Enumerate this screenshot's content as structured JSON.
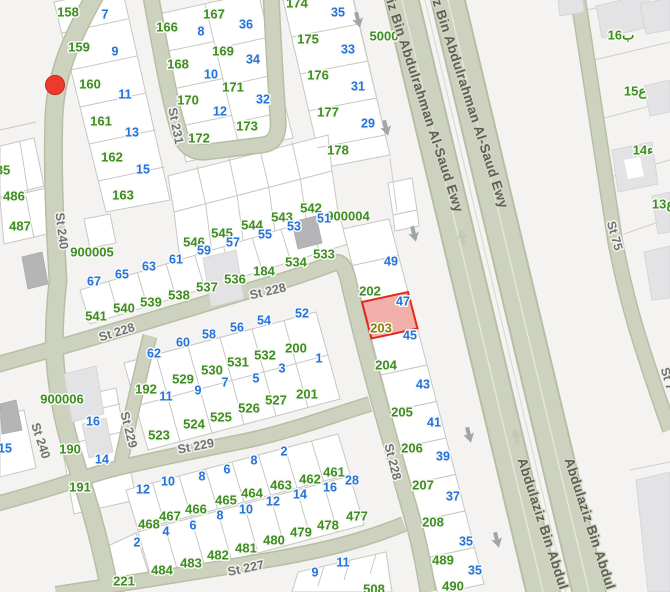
{
  "map": {
    "canvas": {
      "width": 670,
      "height": 592
    },
    "colors": {
      "parcel_number_green": "#3d8e20",
      "house_number_blue": "#2273dd",
      "selected_number_olive": "#8d7c0a",
      "street_label_gray": "#6f7273",
      "highway_label": "#5d6155",
      "road_fill": "#cdd2be",
      "selected_parcel_fill": "#f2a29c",
      "selected_parcel_stroke": "#e02a1e",
      "marker_red": "#ee3a2e"
    },
    "marker": {
      "x": 55,
      "y": 85,
      "r": 9.5
    },
    "selected_parcel": {
      "label": "203",
      "points": "362,302 408,292 417.5,328.5 371.5,338.5"
    },
    "labels": [
      {
        "t": "158",
        "x": 68,
        "y": 13,
        "c": "g"
      },
      {
        "t": "7",
        "x": 105,
        "y": 15,
        "c": "b"
      },
      {
        "t": "159",
        "x": 79,
        "y": 48,
        "c": "g"
      },
      {
        "t": "9",
        "x": 115,
        "y": 52,
        "c": "b"
      },
      {
        "t": "160",
        "x": 90,
        "y": 85,
        "c": "g"
      },
      {
        "t": "11",
        "x": 125,
        "y": 95,
        "c": "b"
      },
      {
        "t": "161",
        "x": 101,
        "y": 122,
        "c": "g"
      },
      {
        "t": "13",
        "x": 132,
        "y": 133,
        "c": "b"
      },
      {
        "t": "162",
        "x": 112,
        "y": 158,
        "c": "g"
      },
      {
        "t": "15",
        "x": 143,
        "y": 170,
        "c": "b"
      },
      {
        "t": "163",
        "x": 123,
        "y": 196,
        "c": "g"
      },
      {
        "t": "166",
        "x": 167,
        "y": 28,
        "c": "g"
      },
      {
        "t": "8",
        "x": 201,
        "y": 32,
        "c": "b"
      },
      {
        "t": "167",
        "x": 214,
        "y": 15,
        "c": "g"
      },
      {
        "t": "36",
        "x": 246,
        "y": 25,
        "c": "b"
      },
      {
        "t": "168",
        "x": 178,
        "y": 65,
        "c": "g"
      },
      {
        "t": "10",
        "x": 211,
        "y": 75,
        "c": "b"
      },
      {
        "t": "169",
        "x": 223,
        "y": 52,
        "c": "g"
      },
      {
        "t": "34",
        "x": 253,
        "y": 60,
        "c": "b"
      },
      {
        "t": "170",
        "x": 188,
        "y": 101,
        "c": "g"
      },
      {
        "t": "12",
        "x": 220,
        "y": 112,
        "c": "b"
      },
      {
        "t": "171",
        "x": 233,
        "y": 88,
        "c": "g"
      },
      {
        "t": "32",
        "x": 263,
        "y": 100,
        "c": "b"
      },
      {
        "t": "172",
        "x": 199,
        "y": 139,
        "c": "g"
      },
      {
        "t": "173",
        "x": 247,
        "y": 127,
        "c": "g"
      },
      {
        "t": "174",
        "x": 297,
        "y": 4,
        "c": "g"
      },
      {
        "t": "35",
        "x": 338,
        "y": 13,
        "c": "b"
      },
      {
        "t": "175",
        "x": 308,
        "y": 40,
        "c": "g"
      },
      {
        "t": "33",
        "x": 348,
        "y": 50,
        "c": "b"
      },
      {
        "t": "176",
        "x": 318,
        "y": 76,
        "c": "g"
      },
      {
        "t": "31",
        "x": 358,
        "y": 87,
        "c": "b"
      },
      {
        "t": "177",
        "x": 328,
        "y": 113,
        "c": "g"
      },
      {
        "t": "29",
        "x": 368,
        "y": 124,
        "c": "b"
      },
      {
        "t": "178",
        "x": 338,
        "y": 151,
        "c": "g"
      },
      {
        "t": "35",
        "x": 3,
        "y": 171,
        "c": "g"
      },
      {
        "t": "486",
        "x": 14,
        "y": 197,
        "c": "g"
      },
      {
        "t": "487",
        "x": 20,
        "y": 227,
        "c": "g"
      },
      {
        "t": "15",
        "x": 5,
        "y": 449,
        "c": "b"
      },
      {
        "t": "5000",
        "x": 384,
        "y": 37,
        "c": "g"
      },
      {
        "t": "900004",
        "x": 348,
        "y": 217,
        "c": "g"
      },
      {
        "t": "900005",
        "x": 92,
        "y": 253,
        "c": "g"
      },
      {
        "t": "900006",
        "x": 62,
        "y": 400,
        "c": "g"
      },
      {
        "t": "546",
        "x": 194,
        "y": 243,
        "c": "g"
      },
      {
        "t": "545",
        "x": 222,
        "y": 234,
        "c": "g"
      },
      {
        "t": "544",
        "x": 252,
        "y": 226,
        "c": "g"
      },
      {
        "t": "543",
        "x": 282,
        "y": 218,
        "c": "g"
      },
      {
        "t": "542",
        "x": 311,
        "y": 209,
        "c": "g"
      },
      {
        "t": "59",
        "x": 204,
        "y": 251,
        "c": "b"
      },
      {
        "t": "57",
        "x": 233,
        "y": 243,
        "c": "b"
      },
      {
        "t": "55",
        "x": 265,
        "y": 235,
        "c": "b"
      },
      {
        "t": "53",
        "x": 294,
        "y": 227,
        "c": "b"
      },
      {
        "t": "51",
        "x": 324,
        "y": 219,
        "c": "b"
      },
      {
        "t": "67",
        "x": 94,
        "y": 282,
        "c": "b"
      },
      {
        "t": "65",
        "x": 122,
        "y": 275,
        "c": "b"
      },
      {
        "t": "63",
        "x": 149,
        "y": 267,
        "c": "b"
      },
      {
        "t": "61",
        "x": 176,
        "y": 260,
        "c": "b"
      },
      {
        "t": "541",
        "x": 96,
        "y": 317,
        "c": "g"
      },
      {
        "t": "540",
        "x": 124,
        "y": 309,
        "c": "g"
      },
      {
        "t": "539",
        "x": 151,
        "y": 303,
        "c": "g"
      },
      {
        "t": "538",
        "x": 179,
        "y": 296,
        "c": "g"
      },
      {
        "t": "537",
        "x": 207,
        "y": 288,
        "c": "g"
      },
      {
        "t": "536",
        "x": 235,
        "y": 280,
        "c": "g"
      },
      {
        "t": "184",
        "x": 264,
        "y": 272,
        "c": "g"
      },
      {
        "t": "534",
        "x": 296,
        "y": 263,
        "c": "g"
      },
      {
        "t": "533",
        "x": 324,
        "y": 255,
        "c": "g"
      },
      {
        "t": "192",
        "x": 146,
        "y": 390,
        "c": "g"
      },
      {
        "t": "62",
        "x": 154,
        "y": 354,
        "c": "b"
      },
      {
        "t": "529",
        "x": 183,
        "y": 380,
        "c": "g"
      },
      {
        "t": "60",
        "x": 183,
        "y": 343,
        "c": "b"
      },
      {
        "t": "530",
        "x": 212,
        "y": 371,
        "c": "g"
      },
      {
        "t": "58",
        "x": 209,
        "y": 335,
        "c": "b"
      },
      {
        "t": "531",
        "x": 238,
        "y": 363,
        "c": "g"
      },
      {
        "t": "56",
        "x": 237,
        "y": 328,
        "c": "b"
      },
      {
        "t": "532",
        "x": 265,
        "y": 356,
        "c": "g"
      },
      {
        "t": "54",
        "x": 264,
        "y": 321,
        "c": "b"
      },
      {
        "t": "200",
        "x": 296,
        "y": 349,
        "c": "g"
      },
      {
        "t": "52",
        "x": 302,
        "y": 314,
        "c": "b"
      },
      {
        "t": "523",
        "x": 159,
        "y": 436,
        "c": "g"
      },
      {
        "t": "11",
        "x": 166,
        "y": 397,
        "c": "b"
      },
      {
        "t": "524",
        "x": 194,
        "y": 425,
        "c": "g"
      },
      {
        "t": "9",
        "x": 198,
        "y": 391,
        "c": "b"
      },
      {
        "t": "525",
        "x": 221,
        "y": 418,
        "c": "g"
      },
      {
        "t": "7",
        "x": 225,
        "y": 383,
        "c": "b"
      },
      {
        "t": "526",
        "x": 249,
        "y": 409,
        "c": "g"
      },
      {
        "t": "5",
        "x": 256,
        "y": 379,
        "c": "b"
      },
      {
        "t": "527",
        "x": 276,
        "y": 401,
        "c": "g"
      },
      {
        "t": "3",
        "x": 282,
        "y": 369,
        "c": "b"
      },
      {
        "t": "201",
        "x": 307,
        "y": 395,
        "c": "g"
      },
      {
        "t": "1",
        "x": 319,
        "y": 359,
        "c": "b"
      },
      {
        "t": "16",
        "x": 93,
        "y": 422,
        "c": "b"
      },
      {
        "t": "190",
        "x": 70,
        "y": 450,
        "c": "g"
      },
      {
        "t": "14",
        "x": 102,
        "y": 460,
        "c": "b"
      },
      {
        "t": "191",
        "x": 80,
        "y": 488,
        "c": "g"
      },
      {
        "t": "49",
        "x": 391,
        "y": 262,
        "c": "b"
      },
      {
        "t": "202",
        "x": 370,
        "y": 292,
        "c": "g"
      },
      {
        "t": "203",
        "x": 381,
        "y": 329,
        "c": "o",
        "n": "selected-parcel-label"
      },
      {
        "t": "47",
        "x": 403,
        "y": 302,
        "c": "b"
      },
      {
        "t": "45",
        "x": 410,
        "y": 336,
        "c": "b"
      },
      {
        "t": "204",
        "x": 386,
        "y": 366,
        "c": "g"
      },
      {
        "t": "43",
        "x": 423,
        "y": 385,
        "c": "b"
      },
      {
        "t": "205",
        "x": 402,
        "y": 413,
        "c": "g"
      },
      {
        "t": "41",
        "x": 434,
        "y": 423,
        "c": "b"
      },
      {
        "t": "206",
        "x": 412,
        "y": 449,
        "c": "g"
      },
      {
        "t": "39",
        "x": 443,
        "y": 457,
        "c": "b"
      },
      {
        "t": "207",
        "x": 423,
        "y": 486,
        "c": "g"
      },
      {
        "t": "37",
        "x": 453,
        "y": 497,
        "c": "b"
      },
      {
        "t": "208",
        "x": 433,
        "y": 523,
        "c": "g"
      },
      {
        "t": "35",
        "x": 466,
        "y": 542,
        "c": "b"
      },
      {
        "t": "489",
        "x": 443,
        "y": 561,
        "c": "g"
      },
      {
        "t": "35",
        "x": 475,
        "y": 571,
        "c": "b"
      },
      {
        "t": "490",
        "x": 453,
        "y": 587,
        "c": "g"
      },
      {
        "t": "12",
        "x": 143,
        "y": 490,
        "c": "b"
      },
      {
        "t": "10",
        "x": 168,
        "y": 482,
        "c": "b"
      },
      {
        "t": "8",
        "x": 202,
        "y": 477,
        "c": "b"
      },
      {
        "t": "6",
        "x": 227,
        "y": 470,
        "c": "b"
      },
      {
        "t": "8",
        "x": 254,
        "y": 461,
        "c": "b"
      },
      {
        "t": "2",
        "x": 284,
        "y": 452,
        "c": "b"
      },
      {
        "t": "468",
        "x": 149,
        "y": 525,
        "c": "g"
      },
      {
        "t": "467",
        "x": 170,
        "y": 517,
        "c": "g"
      },
      {
        "t": "466",
        "x": 196,
        "y": 510,
        "c": "g"
      },
      {
        "t": "465",
        "x": 226,
        "y": 501,
        "c": "g"
      },
      {
        "t": "464",
        "x": 252,
        "y": 494,
        "c": "g"
      },
      {
        "t": "463",
        "x": 281,
        "y": 486,
        "c": "g"
      },
      {
        "t": "462",
        "x": 310,
        "y": 480,
        "c": "g"
      },
      {
        "t": "461",
        "x": 334,
        "y": 473,
        "c": "g"
      },
      {
        "t": "28",
        "x": 352,
        "y": 481,
        "c": "b"
      },
      {
        "t": "16",
        "x": 330,
        "y": 488,
        "c": "b"
      },
      {
        "t": "14",
        "x": 300,
        "y": 495,
        "c": "b"
      },
      {
        "t": "12",
        "x": 273,
        "y": 502,
        "c": "b"
      },
      {
        "t": "10",
        "x": 246,
        "y": 510,
        "c": "b"
      },
      {
        "t": "8",
        "x": 220,
        "y": 516,
        "c": "b"
      },
      {
        "t": "6",
        "x": 193,
        "y": 526,
        "c": "b"
      },
      {
        "t": "4",
        "x": 166,
        "y": 532,
        "c": "b"
      },
      {
        "t": "2",
        "x": 137,
        "y": 543,
        "c": "b"
      },
      {
        "t": "221",
        "x": 124,
        "y": 582,
        "c": "g"
      },
      {
        "t": "484",
        "x": 162,
        "y": 571,
        "c": "g"
      },
      {
        "t": "483",
        "x": 191,
        "y": 564,
        "c": "g"
      },
      {
        "t": "482",
        "x": 218,
        "y": 556,
        "c": "g"
      },
      {
        "t": "481",
        "x": 246,
        "y": 549,
        "c": "g"
      },
      {
        "t": "480",
        "x": 274,
        "y": 541,
        "c": "g"
      },
      {
        "t": "479",
        "x": 301,
        "y": 533,
        "c": "g"
      },
      {
        "t": "478",
        "x": 328,
        "y": 526,
        "c": "g"
      },
      {
        "t": "477",
        "x": 357,
        "y": 517,
        "c": "g"
      },
      {
        "t": "9",
        "x": 315,
        "y": 573,
        "c": "b"
      },
      {
        "t": "11",
        "x": 343,
        "y": 563,
        "c": "b"
      },
      {
        "t": "508",
        "x": 374,
        "y": 590,
        "c": "g"
      },
      {
        "t": "ب16",
        "x": 621,
        "y": 36,
        "c": "g"
      },
      {
        "t": "ع15",
        "x": 635,
        "y": 92,
        "c": "g"
      },
      {
        "t": "ء14",
        "x": 643,
        "y": 151,
        "c": "g"
      },
      {
        "t": "ع13",
        "x": 663,
        "y": 205,
        "c": "g"
      },
      {
        "t": "St 240",
        "x": 61,
        "y": 231,
        "c": "st",
        "r": 83
      },
      {
        "t": "St 240",
        "x": 40,
        "y": 441,
        "c": "st",
        "r": 72
      },
      {
        "t": "St 231",
        "x": 175,
        "y": 126,
        "c": "st",
        "r": 79
      },
      {
        "t": "St 228",
        "x": 117,
        "y": 333,
        "c": "st",
        "r": -17
      },
      {
        "t": "St 228",
        "x": 268,
        "y": 292,
        "c": "st",
        "r": -13
      },
      {
        "t": "St 228",
        "x": 392,
        "y": 462,
        "c": "st",
        "r": 76
      },
      {
        "t": "St 229",
        "x": 128,
        "y": 430,
        "c": "st",
        "r": 76
      },
      {
        "t": "St 229",
        "x": 196,
        "y": 447,
        "c": "st",
        "r": -11
      },
      {
        "t": "St 227",
        "x": 246,
        "y": 569,
        "c": "st",
        "r": -12
      },
      {
        "t": "St 75",
        "x": 614,
        "y": 236,
        "c": "st",
        "r": 74
      },
      {
        "t": "St 7",
        "x": 667,
        "y": 379,
        "c": "st",
        "r": 74
      },
      {
        "t": "iz Bin Abdulrahman Al-Saud Ewy",
        "x": 424,
        "y": 106,
        "c": "hw",
        "r": 72
      },
      {
        "t": "iz Bin Abdulrahman Al-Saud Ewy",
        "x": 469,
        "y": 102,
        "c": "hw",
        "r": 72
      },
      {
        "t": "Abdulaziz Bin Abdul",
        "x": 542,
        "y": 524,
        "c": "hw",
        "r": 72
      },
      {
        "t": "Abdulaziz Bin Abdul",
        "x": 589,
        "y": 524,
        "c": "hw",
        "r": 72
      }
    ],
    "arrows": [
      {
        "x": 358,
        "y": 20,
        "r": 166,
        "l": 0
      },
      {
        "x": 386,
        "y": 128,
        "r": 166,
        "l": 0
      },
      {
        "x": 414,
        "y": 234,
        "r": 166,
        "l": 0
      },
      {
        "x": 462,
        "y": 237,
        "r": -14,
        "l": 1
      },
      {
        "x": 469,
        "y": 435,
        "r": 166,
        "l": 0
      },
      {
        "x": 516,
        "y": 436,
        "r": -14,
        "l": 1
      },
      {
        "x": 497,
        "y": 540,
        "r": 166,
        "l": 0
      }
    ]
  }
}
